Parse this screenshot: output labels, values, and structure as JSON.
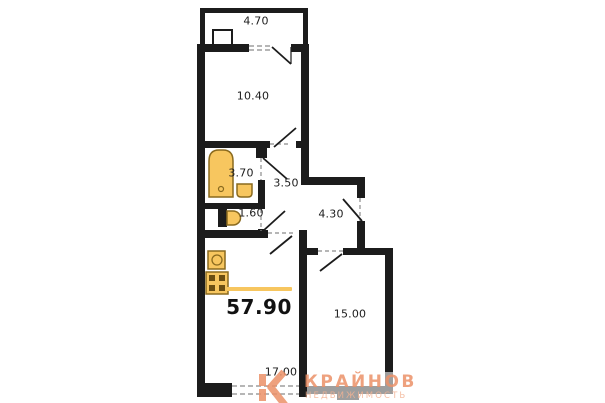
{
  "floor_plan": {
    "total_area": "57.90",
    "rooms": [
      {
        "id": "balcony",
        "area": "4.70"
      },
      {
        "id": "bedroom",
        "area": "10.40"
      },
      {
        "id": "bathroom",
        "area": "3.70"
      },
      {
        "id": "hallway",
        "area": "3.50"
      },
      {
        "id": "wc",
        "area": "1.60"
      },
      {
        "id": "corridor",
        "area": "4.30"
      },
      {
        "id": "room",
        "area": "15.00"
      },
      {
        "id": "living-kitchen",
        "area": "17.00"
      }
    ],
    "fixtures": [
      "bathtub",
      "washbasin",
      "toilet",
      "kitchen-sink",
      "stove"
    ],
    "colors": {
      "wall": "#1c1c1c",
      "wall_gray": "#9e9e9e",
      "fixture_fill": "#F7C65F",
      "fixture_stroke": "#8A6A1E",
      "accent_bar": "#F7C65F",
      "logo_primary": "#EC9168",
      "logo_secondary": "#F2B293"
    }
  },
  "watermark": {
    "title": "КРАЙНОВ",
    "subtitle": "НЕДВИЖИМОСТЬ"
  }
}
